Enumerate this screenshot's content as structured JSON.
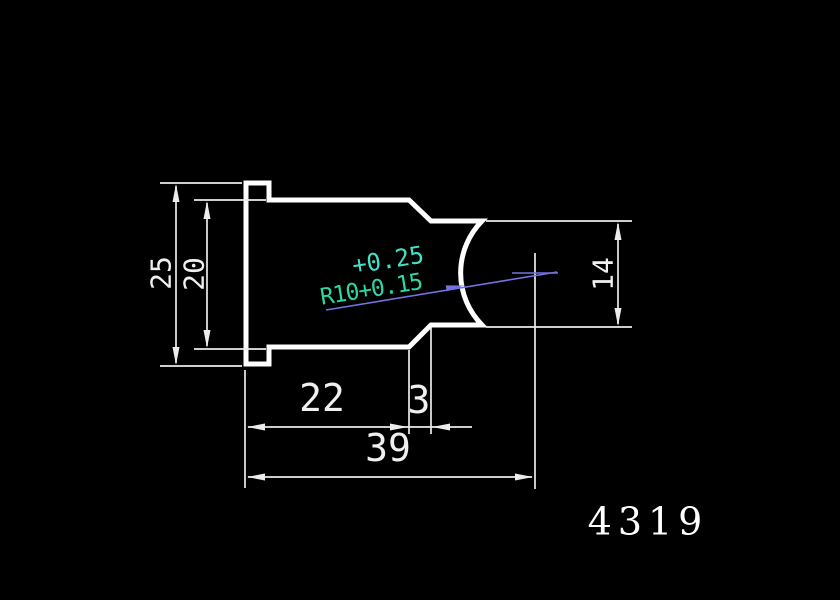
{
  "window": {
    "background": "#000000"
  },
  "colors": {
    "geometry_outline": "#ffffff",
    "dimension_lines": "#ececec",
    "dimension_text": "#f0f0f0",
    "upper_tolerance_text": "#45e0c8",
    "radius_text": "#2bd8a4",
    "leader_line": "#7272e0"
  },
  "drawing": {
    "part_number": "4319",
    "dimensions": {
      "flange_height": "25",
      "body_height": "20",
      "tip_height": "14",
      "body_length": "22",
      "neck_length": "3",
      "overall_length": "39"
    },
    "radius_callout": {
      "upper_tolerance": "+0.25",
      "radius_value": "R10+0.15"
    }
  }
}
